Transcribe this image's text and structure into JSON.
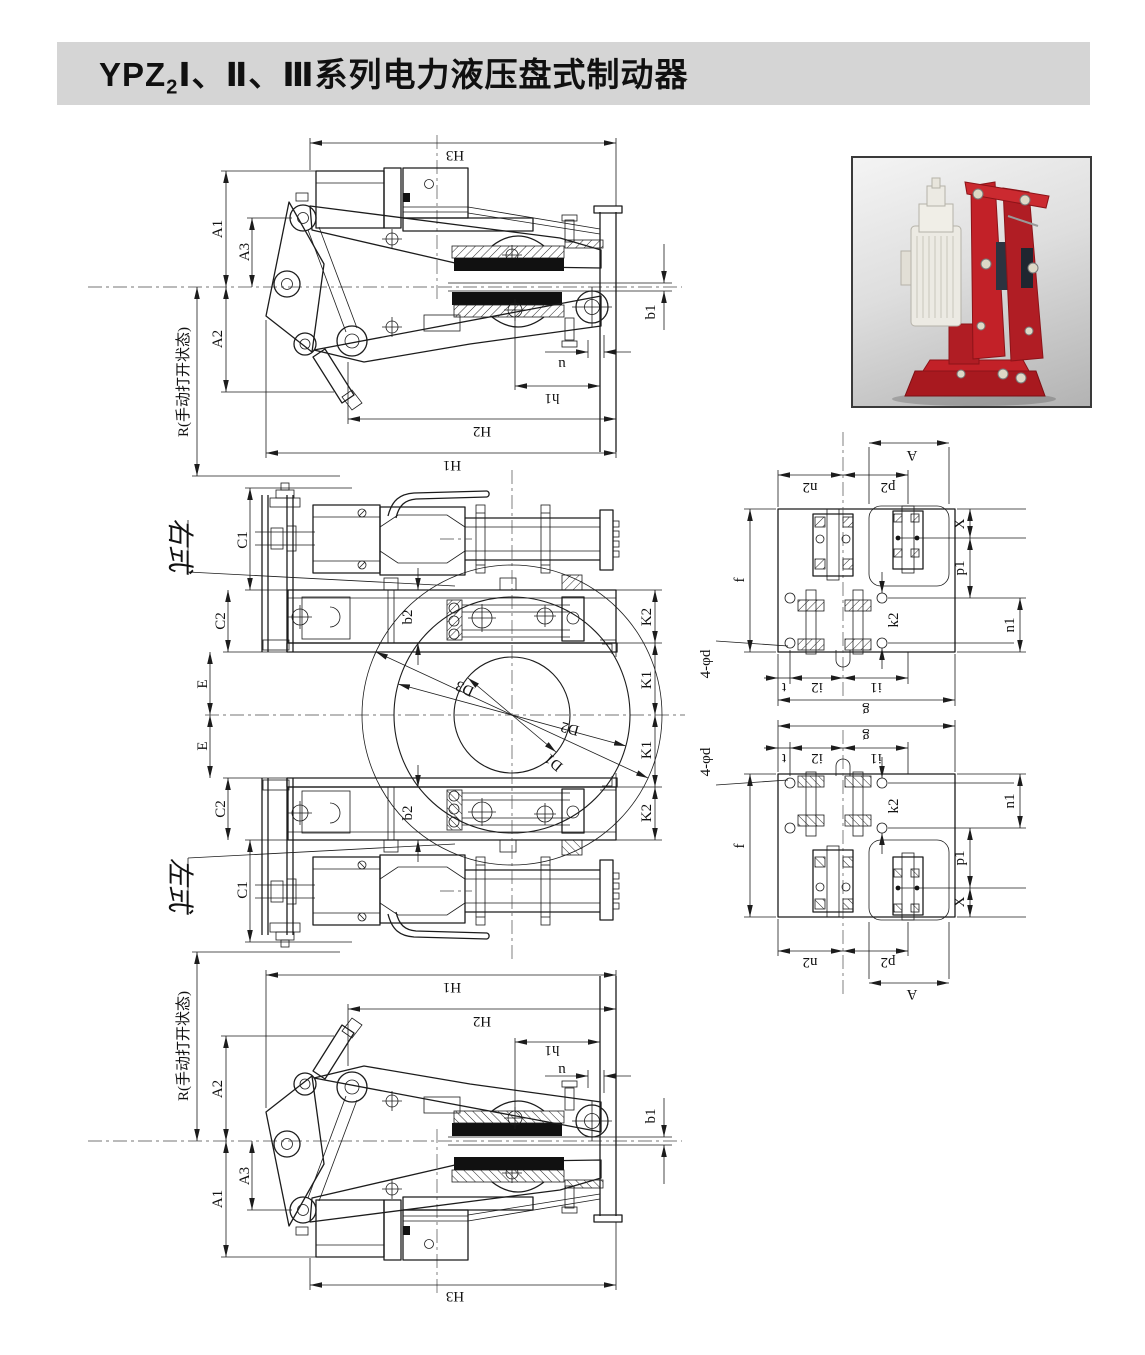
{
  "title": {
    "prefix": "YPZ",
    "subscript": "2",
    "rest": "Ⅰ、Ⅱ、Ⅲ系列电力液压盘式制动器"
  },
  "colors": {
    "title_bar_bg": "#d5d5d5",
    "title_text": "#101010",
    "drawing_line": "#1c1c1c",
    "photo_brake_red": "#c22128",
    "photo_brake_dark_red": "#a8191f",
    "photo_thruster_cream": "#eceae3",
    "photo_background": "#c9c9c9"
  },
  "labels": {
    "H1": "H1",
    "H2": "H2",
    "H3": "H3",
    "A1": "A1",
    "A2": "A2",
    "A3": "A3",
    "R_state": "R(手动打开状态)",
    "b1": "b1",
    "u": "u",
    "h1": "h1",
    "right_type": "右式",
    "left_type": "左式",
    "C1": "C1",
    "C2": "C2",
    "E": "E",
    "b2": "b2",
    "K1": "K1",
    "K2": "K2",
    "D1": "D1",
    "D2": "D2",
    "D3": "D3",
    "f": "f",
    "g": "g",
    "t": "t",
    "i1": "i1",
    "i2": "i2",
    "n1": "n1",
    "n2": "n2",
    "p1": "p1",
    "p2": "p2",
    "k2": "k2",
    "X": "X",
    "A": "A",
    "holes": "4-φd"
  }
}
